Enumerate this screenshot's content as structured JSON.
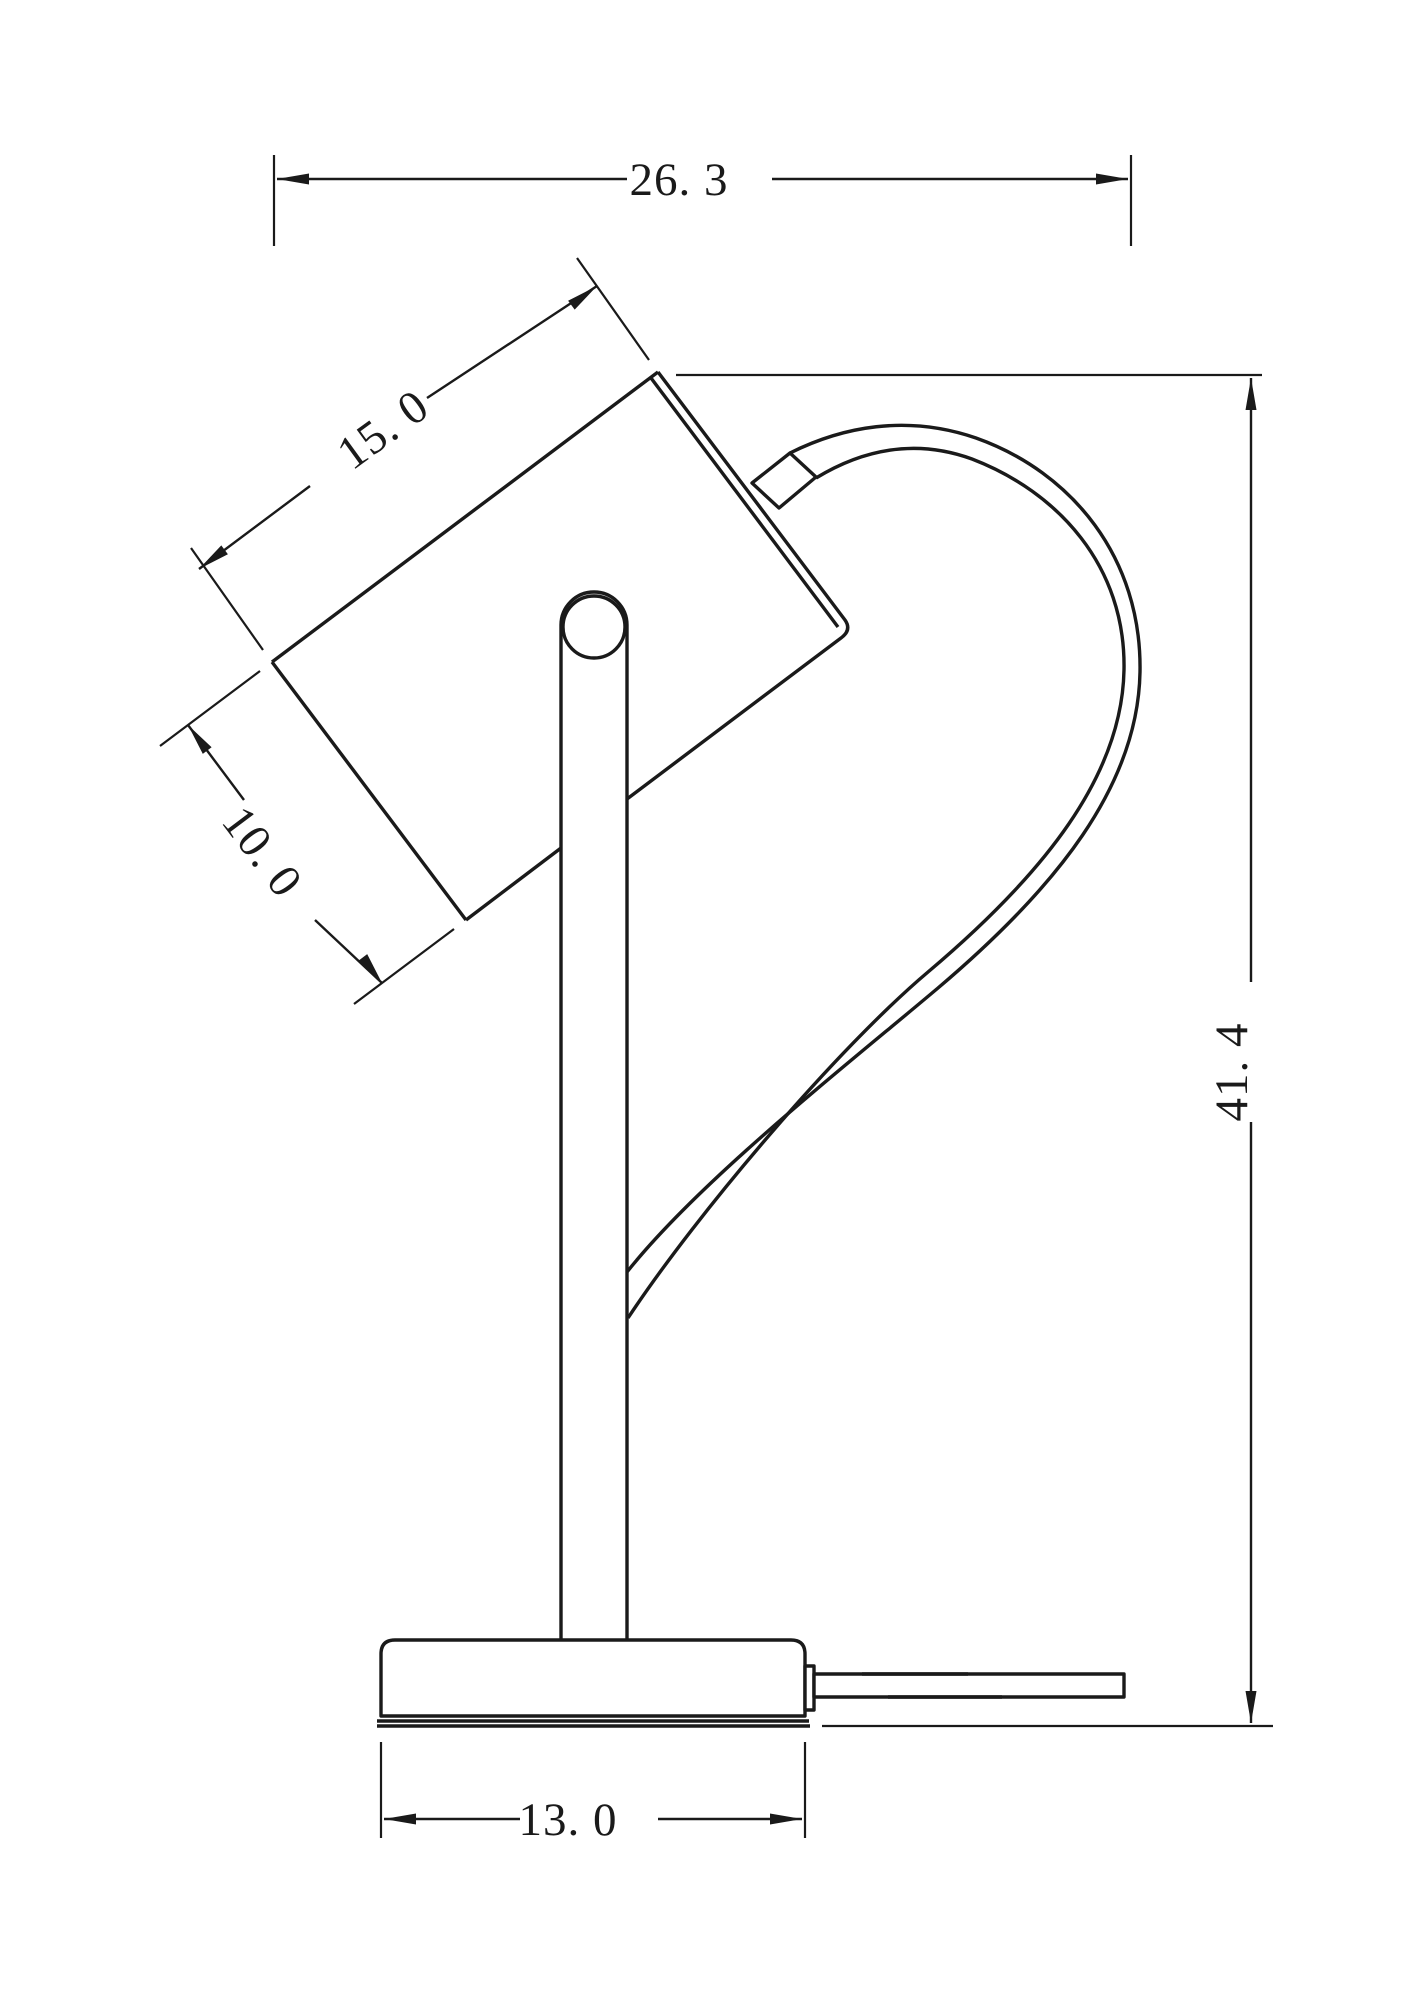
{
  "drawing": {
    "object": "desk-lamp-side-elevation",
    "colors": {
      "line": "#1a1a1a",
      "background": "#ffffff"
    },
    "dimensions": {
      "overall_width": {
        "label": "26. 3",
        "value": 26.3
      },
      "head_length": {
        "label": "15. 0",
        "value": 15.0
      },
      "head_depth": {
        "label": "10. 0",
        "value": 10.0
      },
      "overall_height": {
        "label": "41. 4",
        "value": 41.4
      },
      "base_width": {
        "label": "13. 0",
        "value": 13.0
      }
    }
  }
}
